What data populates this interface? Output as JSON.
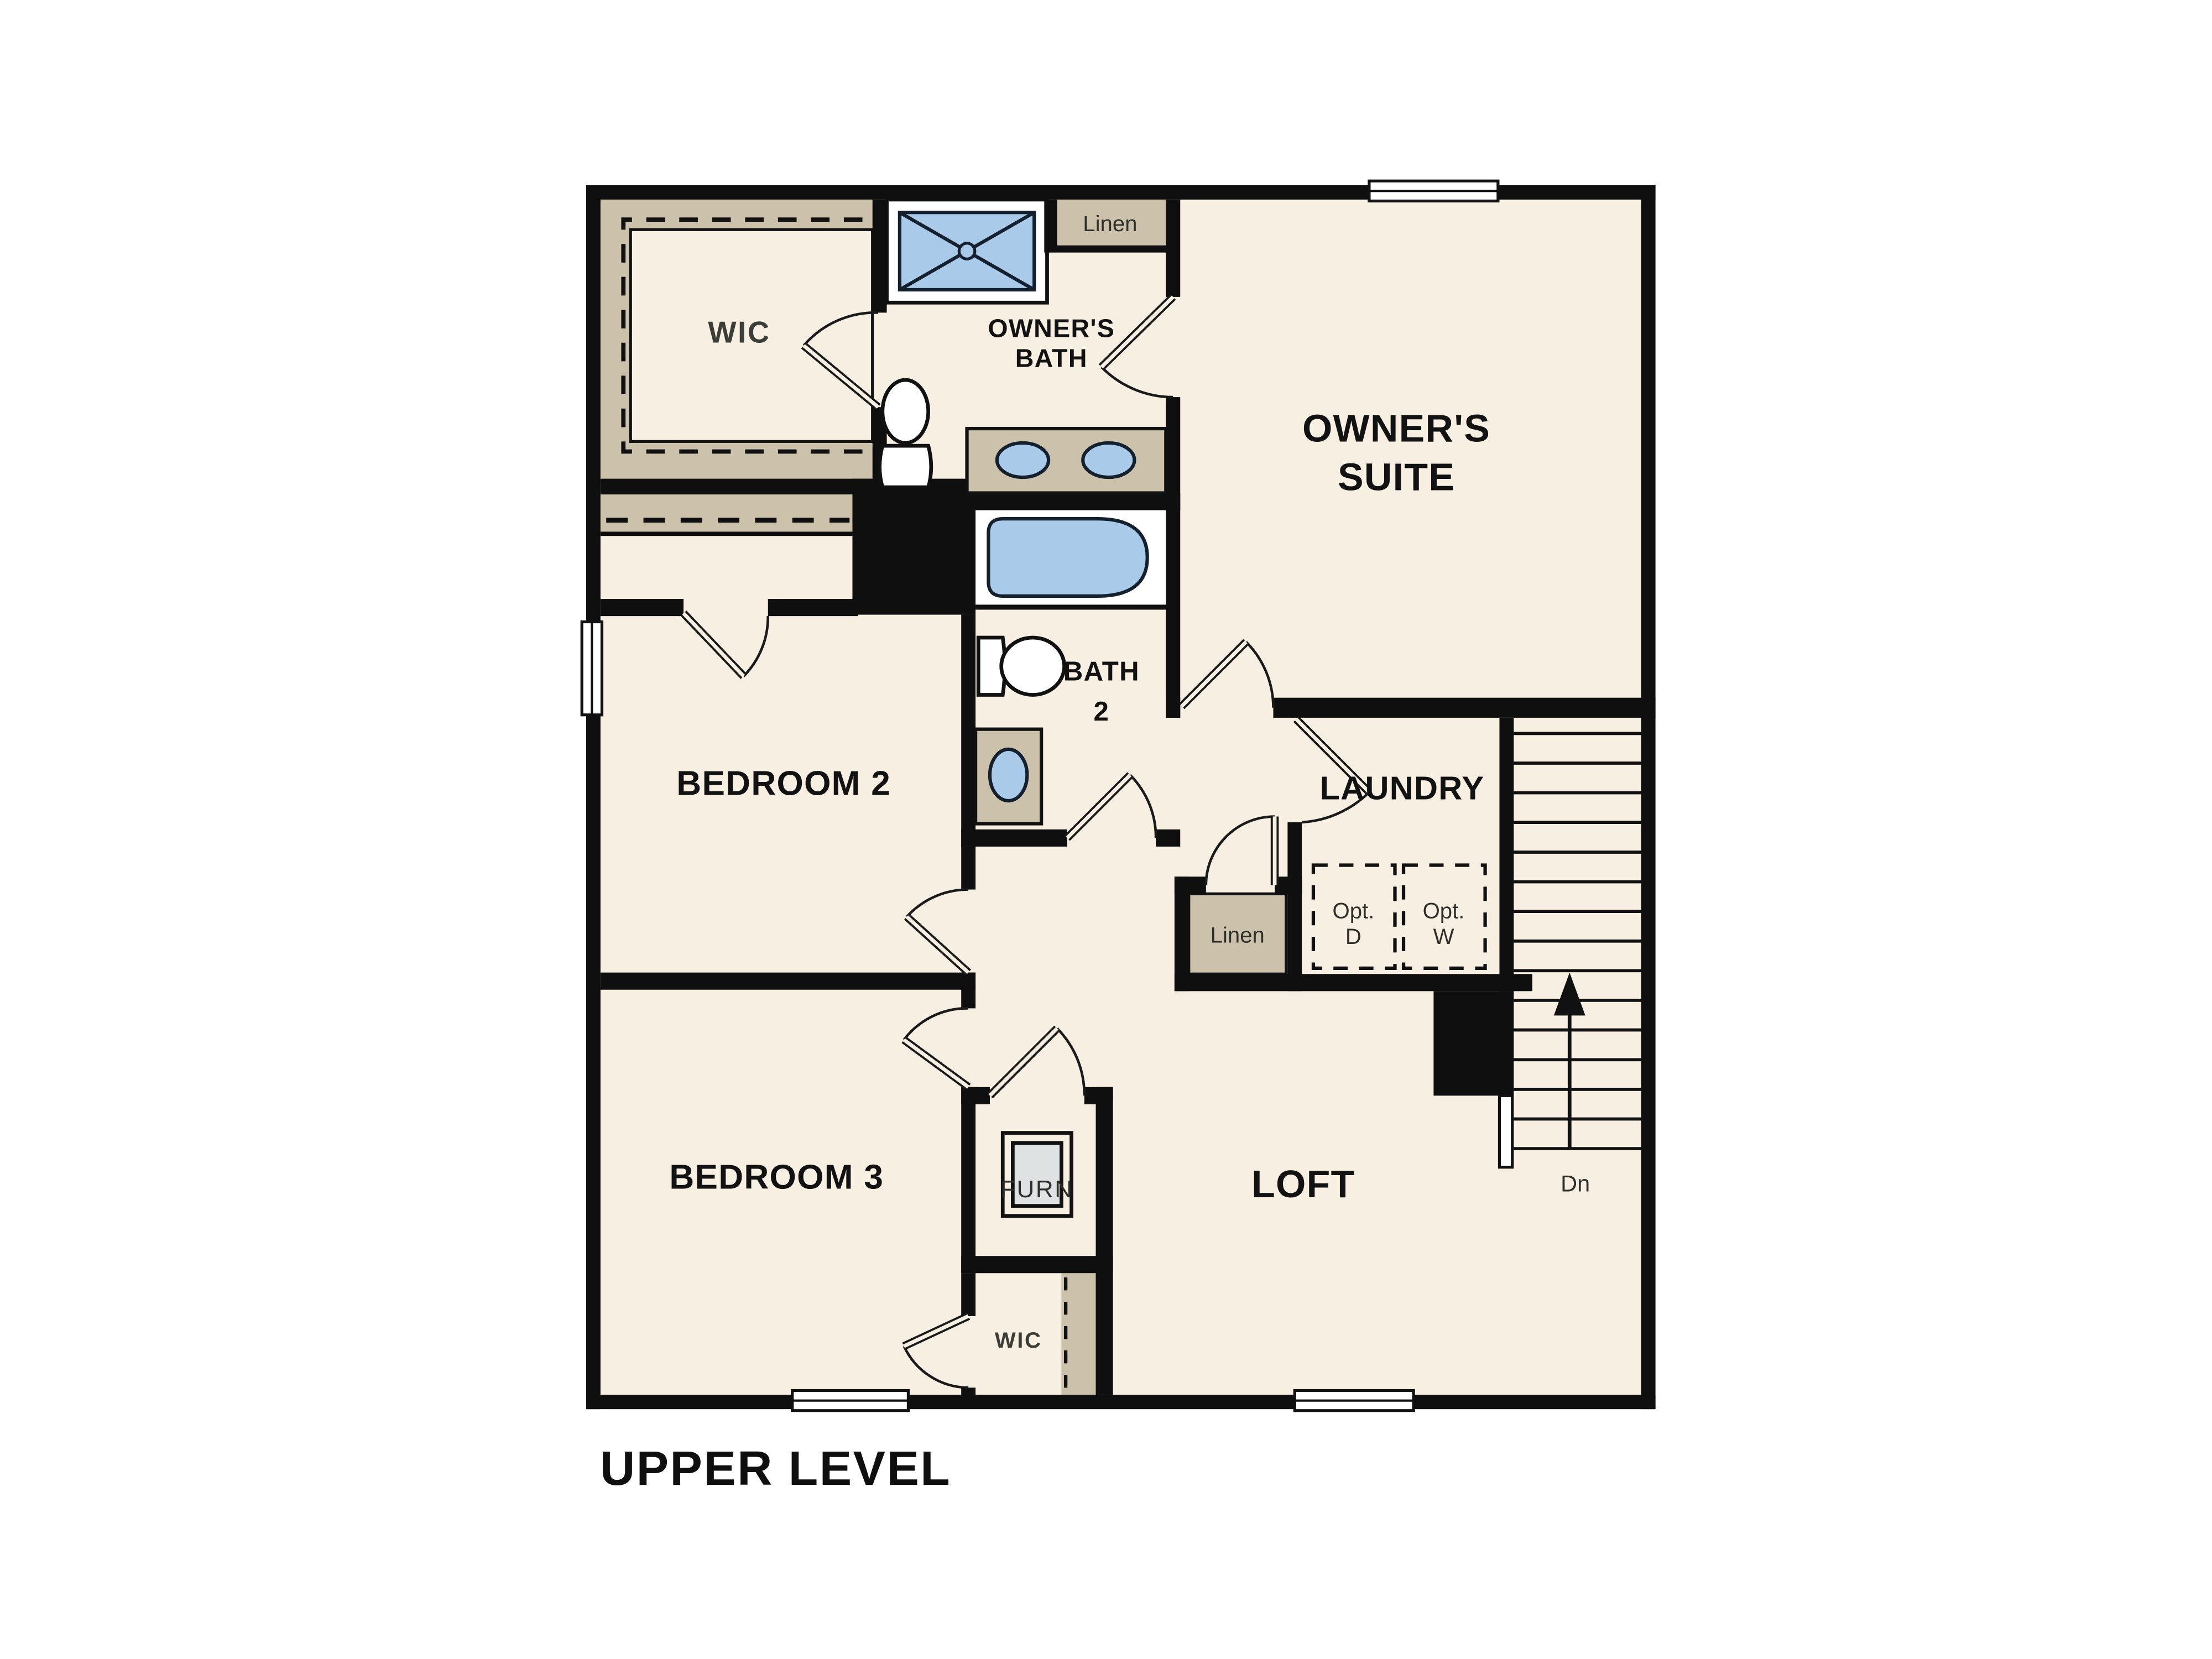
{
  "floor_plan": {
    "title": "UPPER LEVEL",
    "colors": {
      "background": "#ffffff",
      "wall": "#0f0f0f",
      "floor": "#f6efe2",
      "closet_tan": "#ccc2ab",
      "fixture_blue": "#a9cbe9",
      "appliance_gray": "#dfe2e3"
    },
    "labels": {
      "wic_top": "WIC",
      "owners_bath_line1": "OWNER'S",
      "owners_bath_line2": "BATH",
      "linen_top": "Linen",
      "owners_suite_line1": "OWNER'S",
      "owners_suite_line2": "SUITE",
      "bedroom2": "BEDROOM 2",
      "bath2_line1": "BATH",
      "bath2_line2": "2",
      "laundry": "LAUNDRY",
      "linen_bottom": "Linen",
      "opt_dryer_line1": "Opt.",
      "opt_dryer_line2": "D",
      "opt_washer_line1": "Opt.",
      "opt_washer_line2": "W",
      "bedroom3": "BEDROOM 3",
      "furnace": "FURN",
      "wic_bottom": "WIC",
      "loft": "LOFT",
      "stairs_down": "Dn"
    }
  }
}
